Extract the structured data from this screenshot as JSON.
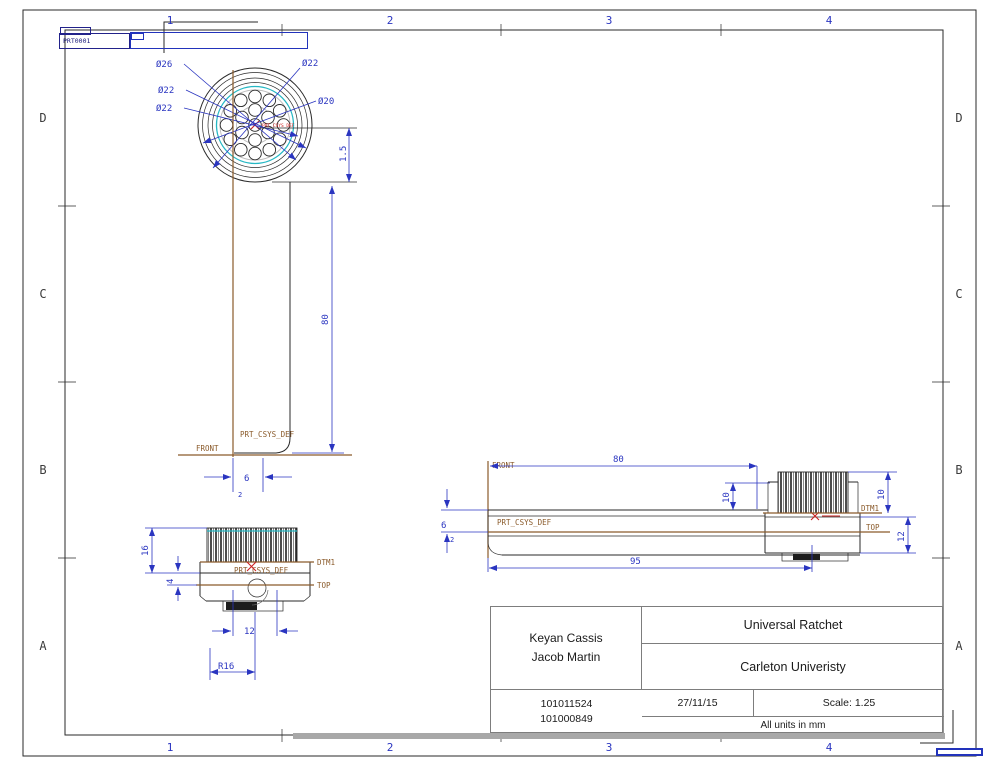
{
  "format_label": "PRT0001",
  "zones": {
    "cols": [
      "1",
      "2",
      "3",
      "4"
    ],
    "rows": [
      "D",
      "C",
      "B",
      "A"
    ]
  },
  "title_block": {
    "author_1": "Keyan Cassis",
    "author_2": "Jacob Martin",
    "title": "Universal Ratchet",
    "organization": "Carleton Univeristy",
    "id_1": "101011524",
    "id_2": "101000849",
    "date": "27/11/15",
    "scale": "Scale: 1.25",
    "units_note": "All units in mm"
  },
  "views": {
    "top": {
      "dia_26": "Ø26",
      "dia_22_a": "Ø22",
      "dia_22_b": "Ø22",
      "dia_22_c": "Ø22",
      "dia_22_d": "Ø22",
      "dia_20": "Ø20",
      "dim_1_5": "1.5",
      "csys": "PRT_CSYS_DEF"
    },
    "handle": {
      "dim_80": "80",
      "dim_6": "6",
      "dim_2": "2",
      "front": "FRONT",
      "csys": "PRT_CSYS_DEF"
    },
    "front": {
      "dim_16": "16",
      "dim_4": "4",
      "dim_12": "12",
      "dim_r16": "R16",
      "dtm1": "DTM1",
      "top": "TOP",
      "csys": "PRT_CSYS_DEF"
    },
    "side": {
      "dim_80": "80",
      "dim_95": "95",
      "dim_10_a": "10",
      "dim_10_b": "10",
      "dim_12": "12",
      "dim_6": "6",
      "dim_2": "2",
      "front": "FRONT",
      "top": "TOP",
      "dtm1": "DTM1",
      "csys": "PRT_CSYS_DEF"
    }
  },
  "colors": {
    "dimension_blue": "#2a35c0",
    "datum_brown": "#8a5a2a",
    "highlight_cyan": "#26b8c4",
    "csys_red": "#cc2020",
    "line_black": "#2a2a2a"
  }
}
